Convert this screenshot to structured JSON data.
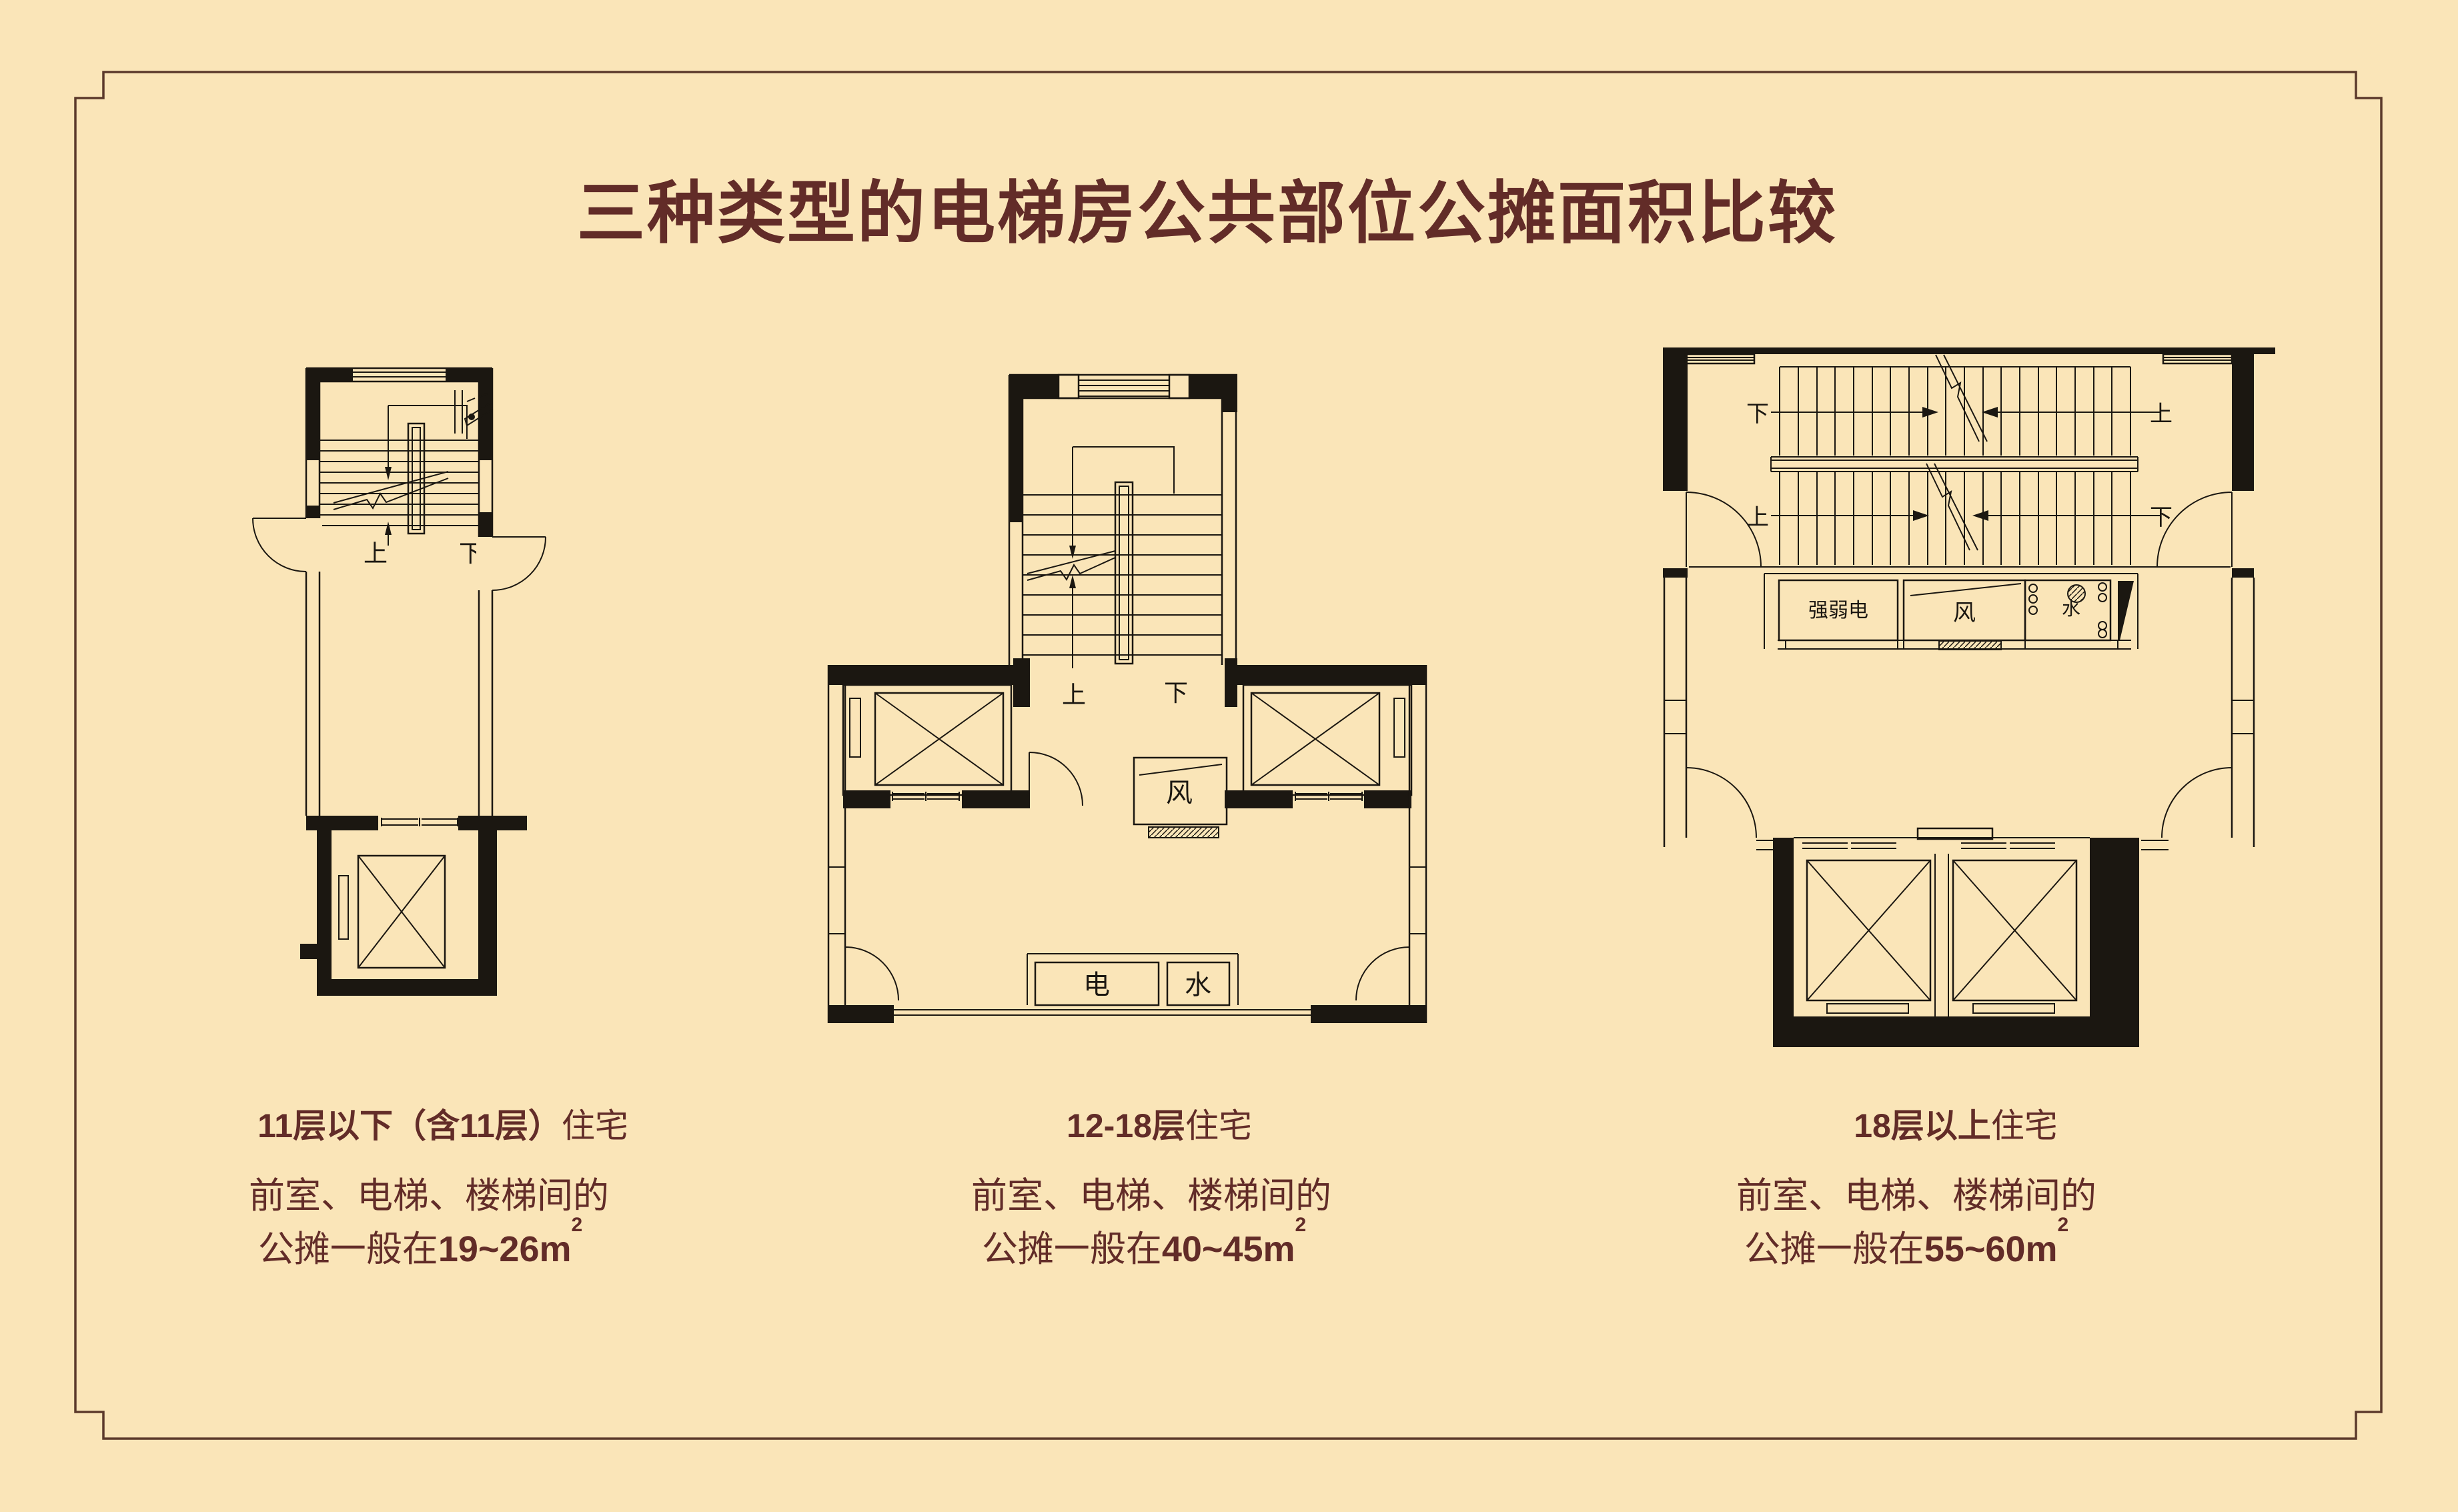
{
  "title": "三种类型的电梯房公共部位公摊面积比较",
  "colors": {
    "background": "#FAE5B8",
    "ink": "#1B1711",
    "accent": "#622C28"
  },
  "plans": [
    {
      "heading_bold": "11层以下（含11层）",
      "heading_regular": "住宅",
      "caption_line1": "前室、电梯、楼梯间的",
      "caption_prefix": "公摊一般在",
      "caption_value": "19~26m",
      "caption_sup": "2",
      "labels": {
        "up": "上",
        "down": "下"
      }
    },
    {
      "heading_bold": "12-18层",
      "heading_regular": "住宅",
      "caption_line1": "前室、电梯、楼梯间的",
      "caption_prefix": "公摊一般在",
      "caption_value": "40~45m",
      "caption_sup": "2",
      "labels": {
        "up": "上",
        "down": "下",
        "air": "风",
        "electric": "电",
        "water": "水"
      }
    },
    {
      "heading_bold": "18层以上",
      "heading_regular": "住宅",
      "caption_line1": "前室、电梯、楼梯间的",
      "caption_prefix": "公摊一般在",
      "caption_value": "55~60m",
      "caption_sup": "2",
      "labels": {
        "up": "上",
        "down": "下",
        "strong_weak_electric": "强弱电",
        "air": "风",
        "water": "水"
      }
    }
  ]
}
